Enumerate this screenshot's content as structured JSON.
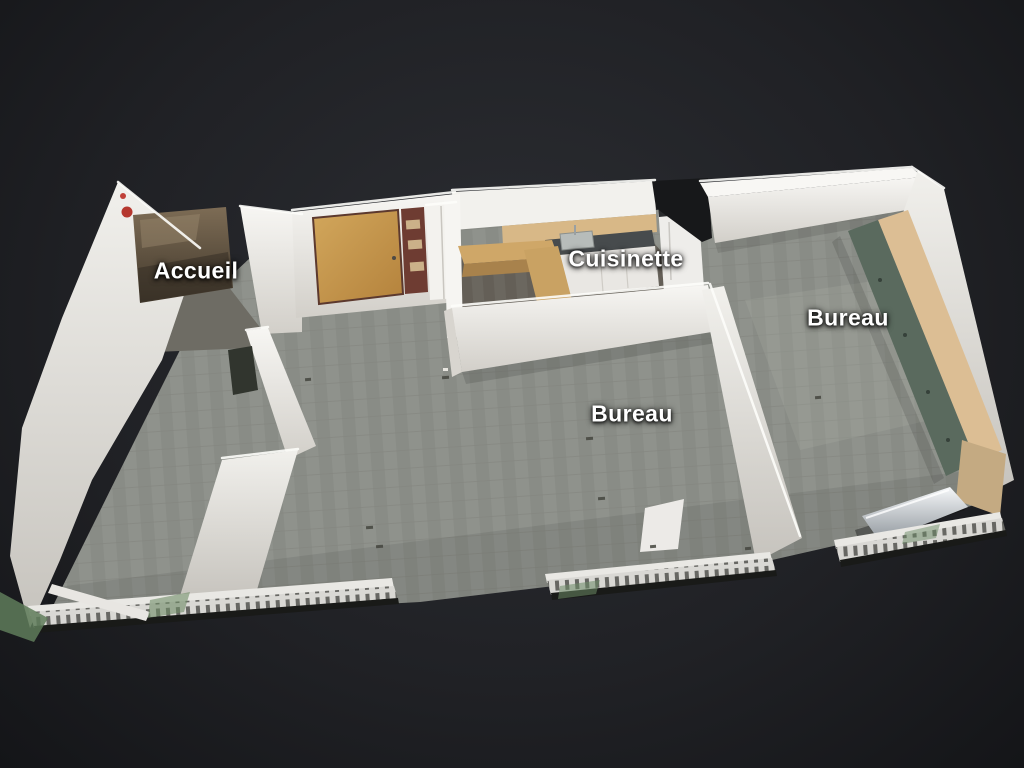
{
  "view": {
    "background_center_color": "#2c2e33",
    "background_edge_color": "#141518",
    "label_text_color": "#ffffff"
  },
  "labels": [
    {
      "id": "accueil",
      "text": "Accueil"
    },
    {
      "id": "cuisinette",
      "text": "Cuisinette"
    },
    {
      "id": "bureau-right",
      "text": "Bureau"
    },
    {
      "id": "bureau-center",
      "text": "Bureau"
    }
  ],
  "materials": {
    "wall_color": "#efeeea",
    "carpet_color": "#8f928c",
    "kitchen_floor_color": "#6b675f",
    "wood_counter_color": "#cfa768",
    "door_color": "#c89a52",
    "desk_panel_color": "#5a6a5e",
    "desk_top_wood_color": "#dcbe94",
    "countertop_color": "#474b4d",
    "heater_color": "#d9d8d4",
    "alarm_red_color": "#b5372e",
    "vegetation_color": "#5f7d5a",
    "mirror_color": "#5d4f3f"
  }
}
